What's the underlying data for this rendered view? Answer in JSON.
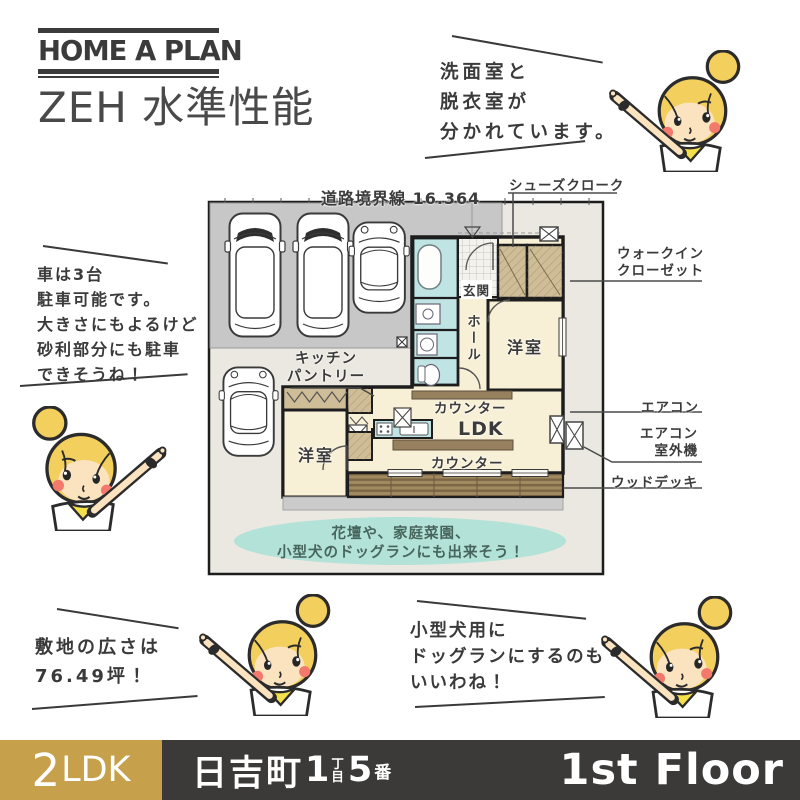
{
  "header": {
    "logo": "HOME A PLAN",
    "subtitle": "ZEH 水準性能"
  },
  "bubbles": {
    "top_right": {
      "lines": [
        "洗面室と",
        "脱衣室が",
        "分かれています。"
      ]
    },
    "mid_left": {
      "lines": [
        "車は3台",
        "駐車可能です。",
        "大きさにもよるけど",
        "砂利部分にも駐車",
        "できそうね！"
      ]
    },
    "bottom_left": {
      "lines": [
        "敷地の広さは",
        "76.49坪！"
      ]
    },
    "bottom_right": {
      "lines": [
        "小型犬用に",
        "ドッグランにするのも",
        "いいわね！"
      ]
    }
  },
  "floorplan": {
    "boundary_label": "道路境界線 16.364",
    "rooms": {
      "genkan": "玄関",
      "hall": "ホール",
      "bedroom_upper": "洋室",
      "bedroom_lower": "洋室",
      "ldk": "LDK",
      "counter_upper": "カウンター",
      "counter_lower": "カウンター"
    },
    "kitchen_pantry": {
      "lines": [
        "キッチン",
        "パントリー"
      ]
    },
    "garden_note": {
      "lines": [
        "花壇や、家庭菜園、",
        "小型犬のドッグランにも出来そう！"
      ]
    },
    "callouts": {
      "shoe_closet": "シューズクローク",
      "walk_in_closet": {
        "lines": [
          "ウォークイン",
          "クローゼット"
        ]
      },
      "aircon": "エアコン",
      "aircon_outdoor": {
        "lines": [
          "エアコン",
          "室外機"
        ]
      },
      "wood_deck": "ウッドデッキ"
    }
  },
  "footer": {
    "layout_num": "2",
    "layout_txt": "LDK",
    "address": {
      "town": "日吉町",
      "block": "1",
      "chome_top": "丁",
      "chome_bottom": "目",
      "lot": "5",
      "ban": "番"
    },
    "floor": "1st Floor"
  },
  "colors": {
    "accent_gold": "#c7a04b",
    "footer_dark": "#3b3a39",
    "ink": "#3a3a3a",
    "bath_teal": "#c0e3e4",
    "room_cream": "#f8f0d6",
    "closet_tan": "#cfbd98",
    "parking_gray": "#c7c7c7",
    "site_beige": "#eae8e0",
    "deck_brown": "#8a7350",
    "garden_teal": "#b2e2d8",
    "hair_yellow": "#f3cf5e"
  }
}
